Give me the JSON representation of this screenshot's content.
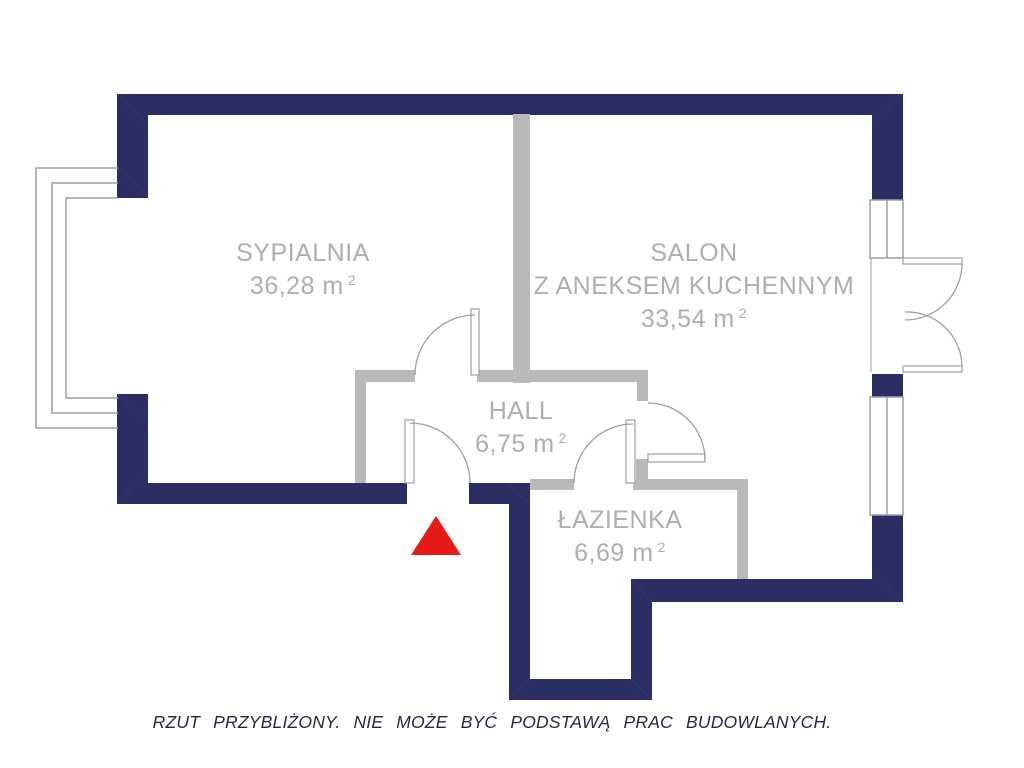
{
  "floor_plan": {
    "rooms": [
      {
        "id": "sypialnia",
        "name": "SYPIALNIA",
        "area": "36,28 m",
        "area_exponent": "2"
      },
      {
        "id": "salon",
        "name": "SALON",
        "name_line2": "Z ANEKSEM KUCHENNYM",
        "area": "33,54 m",
        "area_exponent": "2"
      },
      {
        "id": "hall",
        "name": "HALL",
        "area": "6,75 m",
        "area_exponent": "2"
      },
      {
        "id": "lazienka",
        "name": "ŁAZIENKA",
        "area": "6,69 m",
        "area_exponent": "2"
      }
    ],
    "disclaimer": "RZUT PRZYBLIŻONY. NIE MOŻE BYĆ PODSTAWĄ PRAC BUDOWLANYCH.",
    "colors": {
      "exterior_wall": "#2a2e63",
      "interior_wall": "#b9b9b9",
      "line_color": "#9aa0a5",
      "label_text": "#aeaeae",
      "entrance_marker": "#e41b17",
      "disclaimer_text": "#262940"
    }
  }
}
